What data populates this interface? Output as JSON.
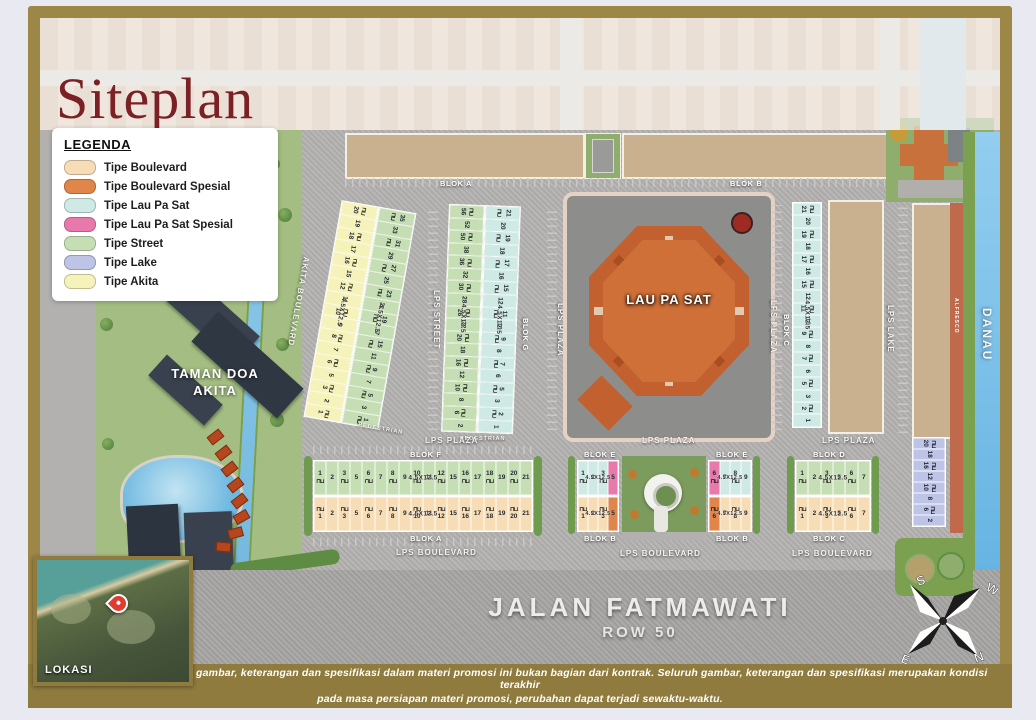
{
  "title": "Siteplan",
  "legend": {
    "title": "LEGENDA",
    "items": [
      {
        "label": "Tipe Boulevard",
        "type": "boulevard"
      },
      {
        "label": "Tipe Boulevard Spesial",
        "type": "boulevard_spesial"
      },
      {
        "label": "Tipe Lau Pa Sat",
        "type": "laupasat"
      },
      {
        "label": "Tipe Lau Pa Sat Spesial",
        "type": "laupasat_spesial"
      },
      {
        "label": "Tipe Street",
        "type": "street"
      },
      {
        "label": "Tipe Lake",
        "type": "lake"
      },
      {
        "label": "Tipe Akita",
        "type": "akita"
      }
    ]
  },
  "colors": {
    "boulevard": "#f7ddb5",
    "boulevard_spesial": "#e1864a",
    "laupasat": "#cfe9e4",
    "laupasat_spesial": "#e779ab",
    "street": "#c6deb4",
    "lake": "#bdc4e6",
    "akita": "#f6f3ba",
    "title_maroon": "#7b2125",
    "frame_gold": "#9c8747",
    "disclaimer_olive": "#8f7b3e",
    "water_blue": "#7fc4ea"
  },
  "unit_icon_glyph": "⊓⊔",
  "landmarks": {
    "lau_pa_sat": "LAU PA SAT",
    "taman_doa_line1": "TAMAN DOA",
    "taman_doa_line2": "AKITA",
    "danau": "DANAU",
    "alfresco": "ALFRESCO",
    "lokasi": "LOKASI"
  },
  "roads": {
    "lps_plaza": "LPS PLAZA",
    "lps_boulevard": "LPS BOULEVARD",
    "lps_street": "LPS STREET",
    "lps_lake": "LPS LAKE",
    "akita_boulevard": "AKITA BOULEVARD",
    "pedestrian": "PEDESTRIAN",
    "jalan_fatmawati": "JALAN FATMAWATI",
    "row_50": "ROW 50"
  },
  "blocks": {
    "blok_a": "BLOK A",
    "blok_b": "BLOK B",
    "blok_c": "BLOK C",
    "blok_d": "BLOK D",
    "blok_e": "BLOK E",
    "blok_f": "BLOK F",
    "blok_g": "BLOK G",
    "unit_size": "4.5X12.5"
  },
  "units": {
    "akita_col": {
      "type": "akita",
      "numbers": [
        "20",
        "19",
        "18",
        "17",
        "16",
        "15",
        "12",
        "11",
        "10",
        "9",
        "8",
        "7",
        "6",
        "5",
        "3",
        "2",
        "1"
      ]
    },
    "street_col": {
      "type": "street",
      "numbers": [
        "35",
        "33",
        "31",
        "29",
        "27",
        "25",
        "23",
        "21",
        "19",
        "17",
        "15",
        "11",
        "9",
        "7",
        "5",
        "3",
        "1"
      ]
    },
    "blok_g_street": {
      "type": "street",
      "numbers": [
        "56",
        "52",
        "50",
        "38",
        "36",
        "32",
        "30",
        "28",
        "26",
        "22",
        "20",
        "18",
        "16",
        "12",
        "10",
        "8",
        "6",
        "2"
      ]
    },
    "blok_g_laupasat": {
      "type": "laupasat",
      "numbers": [
        "21",
        "20",
        "19",
        "18",
        "17",
        "16",
        "15",
        "12",
        "11",
        "10",
        "9",
        "8",
        "7",
        "6",
        "5",
        "3",
        "2",
        "1"
      ]
    },
    "blok_c_laupasat": {
      "type": "laupasat",
      "numbers": [
        "21",
        "20",
        "19",
        "18",
        "17",
        "16",
        "15",
        "12",
        "11",
        "10",
        "9",
        "8",
        "7",
        "6",
        "5",
        "3",
        "2",
        "1"
      ]
    },
    "lake_col": {
      "type": "lake",
      "numbers": [
        "20",
        "18",
        "16",
        "12",
        "10",
        "8",
        "6",
        "2"
      ]
    },
    "blok_f_row": {
      "type": "street",
      "numbers": [
        "1",
        "2",
        "3",
        "5",
        "6",
        "7",
        "8",
        "9",
        "10",
        "11",
        "12",
        "15",
        "16",
        "17",
        "18",
        "19",
        "20",
        "21"
      ]
    },
    "blok_a_row": {
      "type": "boulevard",
      "numbers": [
        "1",
        "2",
        "3",
        "5",
        "6",
        "7",
        "8",
        "9",
        "10",
        "11",
        "12",
        "15",
        "16",
        "17",
        "18",
        "19",
        "20",
        "21"
      ]
    },
    "blok_e_left": {
      "type": "laupasat",
      "numbers": [
        "1",
        "2",
        "3",
        "5"
      ],
      "special_type": "laupasat_spesial",
      "special_numbers": [
        "5"
      ]
    },
    "blok_b_left": {
      "type": "boulevard",
      "numbers": [
        "1",
        "2",
        "3",
        "5"
      ],
      "special_type": "boulevard_spesial",
      "special_numbers": [
        "5"
      ]
    },
    "blok_e_right": {
      "type": "laupasat",
      "numbers": [
        "6",
        "7",
        "8",
        "9"
      ],
      "special_type": "laupasat_spesial",
      "special_numbers": [
        "6"
      ]
    },
    "blok_b_right": {
      "type": "boulevard",
      "numbers": [
        "6",
        "7",
        "8",
        "9"
      ],
      "special_type": "boulevard_spesial",
      "special_numbers": [
        "6"
      ]
    },
    "blok_d_row": {
      "type": "street",
      "numbers": [
        "1",
        "2",
        "3",
        "5",
        "6",
        "7"
      ]
    },
    "blok_c_row": {
      "type": "boulevard",
      "numbers": [
        "1",
        "2",
        "3",
        "5",
        "6",
        "7"
      ]
    }
  },
  "compass": {
    "n": "N",
    "s": "S",
    "e": "E",
    "w": "W"
  },
  "disclaimer": {
    "line1": "Pasal Sanggahan : Seluruh gambar, keterangan dan spesifikasi dalam materi promosi ini bukan bagian dari kontrak. Seluruh gambar, keterangan dan spesifikasi merupakan kondisi terakhir",
    "line2": "pada masa persiapan materi promosi, perubahan dapat terjadi sewaktu-waktu."
  }
}
